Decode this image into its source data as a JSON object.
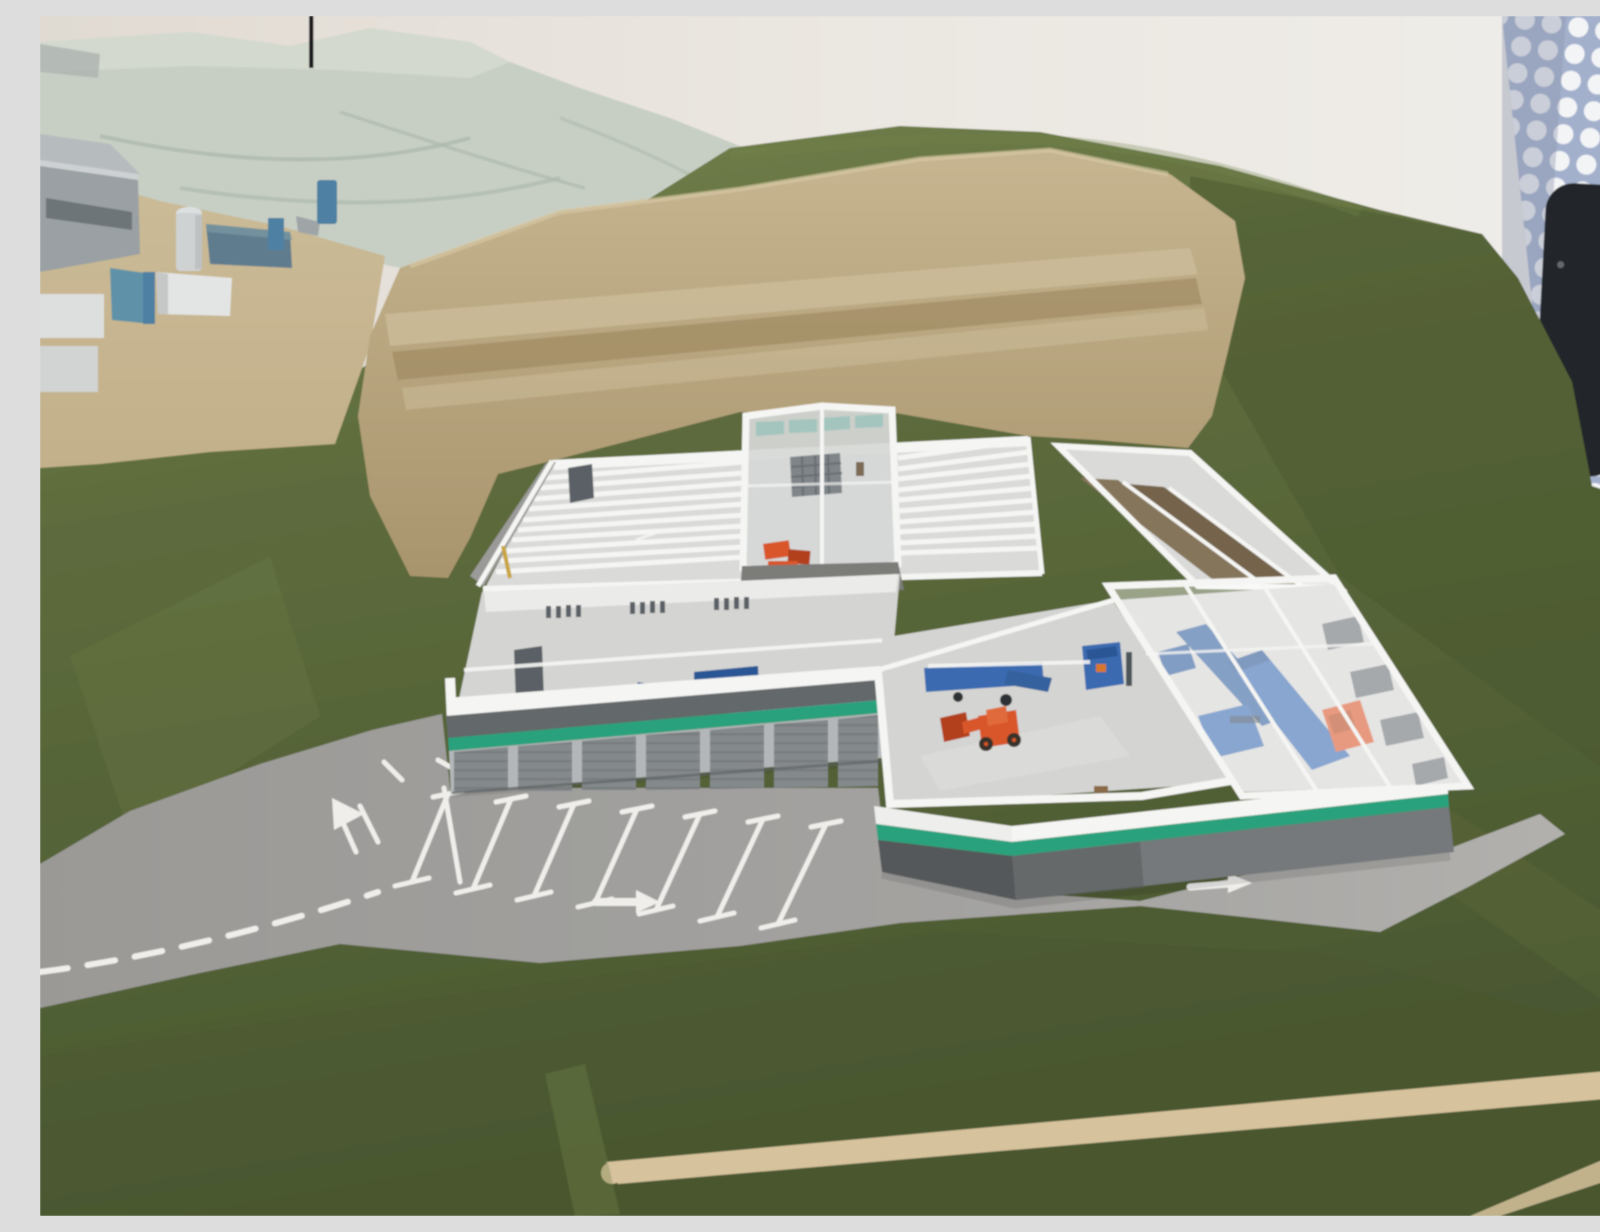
{
  "scene": {
    "description": "Photograph of an architectural scale model: a recycling and waste-management facility with a cut-away white building model (open transparent roof showing bunker bays, a skylight tower, composting tunnels and a sorting hall with blue machinery and orange wheel loaders), a striped parking lot and access road, set in a green flocked hillside with a pale quarry slope and a cluster of small industrial buildings; a dotted glass panel and a black belt stanchion stand in the background."
  },
  "objects": [
    {
      "name": "background-wall",
      "label": "plain exhibition wall"
    },
    {
      "name": "perforated-panel",
      "label": "glass panel with white dot pattern"
    },
    {
      "name": "belt-stanchion",
      "label": "black barrier post with red belt"
    },
    {
      "name": "quarry-hillside",
      "label": "pale rocky quarry slope"
    },
    {
      "name": "antenna-mast",
      "label": "thin black mast on ridge"
    },
    {
      "name": "buildings-cluster",
      "label": "small industrial buildings with silo and blue tanks"
    },
    {
      "name": "grass-hillside",
      "label": "green flocked model landscape"
    },
    {
      "name": "excavated-pit",
      "label": "tan terraced excavation behind facility"
    },
    {
      "name": "facility-model",
      "label": "cut-away recycling facility building"
    },
    {
      "name": "bunker-hall",
      "label": "hall with rows of white storage bays"
    },
    {
      "name": "skylight-tower",
      "label": "tall glazed tower section"
    },
    {
      "name": "composting-tunnels",
      "label": "hall with brown material channels"
    },
    {
      "name": "sorting-hall",
      "label": "glazed wing with blue sorting machines"
    },
    {
      "name": "wheel-loader",
      "label": "orange wheel loader models"
    },
    {
      "name": "parking-lot",
      "label": "parking stalls with white markings"
    },
    {
      "name": "access-road",
      "label": "gray road with arrows and dashed lines"
    }
  ],
  "palette": {
    "wall": "#eae6e0",
    "wall_left": "#e0dad2",
    "panel_blue": "#a3b0cc",
    "panel_dot": "#f3f4f6",
    "stanchion": "#23262b",
    "strap_red": "#8c2a24",
    "quarry": "#c7cfc5",
    "quarry_shadow": "#aeb9ac",
    "quarry_light": "#dce1d6",
    "apron_tan": "#c2b08a",
    "pit_top": "#c6b590",
    "pit_bottom": "#a8946c",
    "pit_light": "#cdbd9b",
    "pit_dark": "#9b855e",
    "grass": "#5d6b3c",
    "grass_dark": "#49572f",
    "grass_light": "#75834c",
    "road": "#a3a2a0",
    "road_light": "#b1b0ad",
    "marking": "#efeeeb",
    "bldg_frame": "#f5f5f3",
    "bldg_fill": "#dadad8",
    "bldg_floor": "#d4d4d2",
    "bldg_wall": "#ebebe9",
    "facade_dark": "#63676a",
    "facade_gray": "#75797b",
    "door_gray": "#84898b",
    "door_jamb": "#b3b7b9",
    "door_rib": "#6e7476",
    "stripe_green": "#2ba17d",
    "teal_glass": "#9fc4bc",
    "machine_blue": "#3a6bb0",
    "machine_blue_dark": "#2c5795",
    "loader_orange": "#d8572b",
    "loader_dark": "#b2411c",
    "brown_strip": "#85755a",
    "brown_strip_dark": "#74644b",
    "window_dark": "#5a6065",
    "silo_gray": "#ced2d3",
    "cluster_gray": "#9aa0a3",
    "cluster_blue": "#5e92a8",
    "cluster_slab": "#5e7b8e",
    "cluster_white": "#e3e5e4",
    "path_tan": "#d6c29c",
    "tower_glass": "#d6d8d7"
  }
}
